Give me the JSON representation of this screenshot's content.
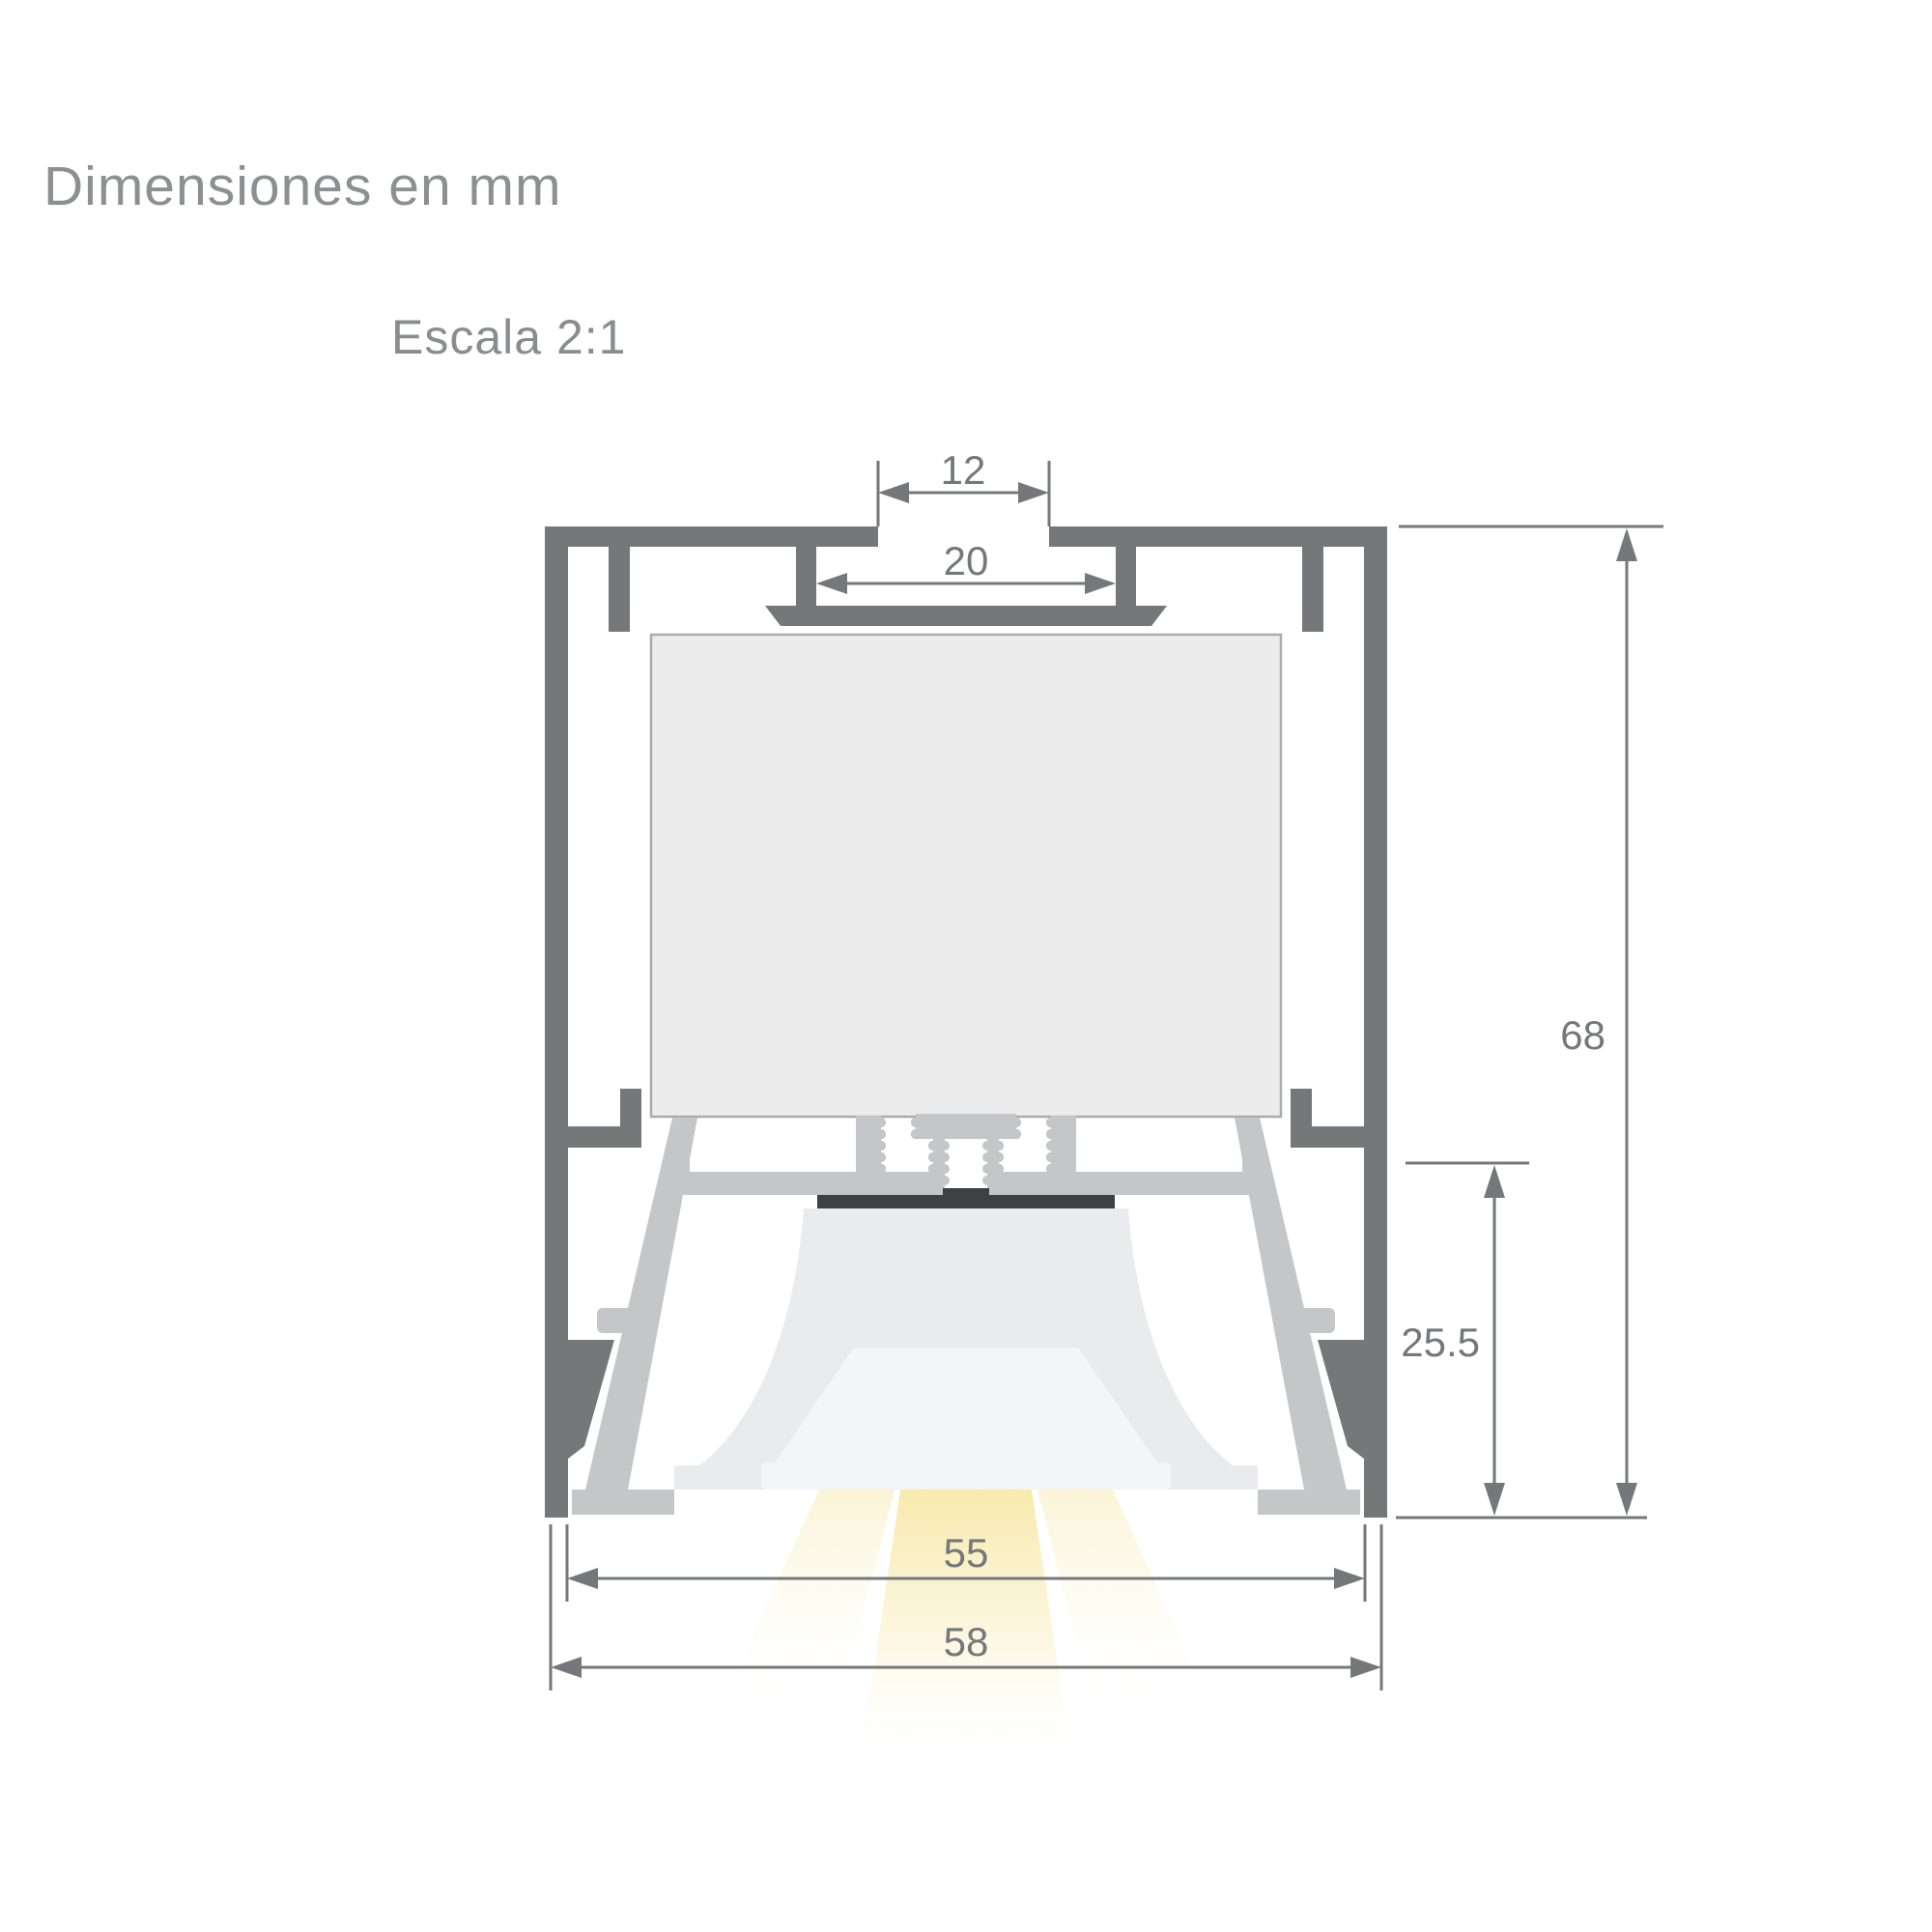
{
  "header": {
    "title": "Dimensiones en mm",
    "scale_label": "Escala 2:1",
    "units": "mm"
  },
  "drawing": {
    "description": "Cross-section technical drawing of a suspended linear LED aluminium profile with internal driver box, screw bosses, LED board, reflector lens and light beam",
    "scale": "2:1",
    "parts": [
      "outer-aluminium-shell",
      "mounting-slot",
      "driver-compartment",
      "screw-bosses",
      "led-board",
      "reflector-lens",
      "diffuser-lip",
      "light-beam"
    ],
    "colors": {
      "profile_gray": "#757779",
      "inner_housing_silver": "#c4c6c8",
      "driver_box_fill": "#ececed",
      "driver_box_border": "#a9abad",
      "lens_gray": "#eaebec",
      "diffuser_white": "#f4f5f6",
      "led_board_dark": "#3e4042",
      "beam_center": "#f7e9a6",
      "beam_side": "#fbf5dd",
      "dimension_gray": "#75777a",
      "title_gray": "#8d8f91"
    }
  },
  "dimensions": {
    "top_slot_width": "12",
    "channel_width": "20",
    "total_height": "68",
    "lower_section_height": "25.5",
    "inner_width": "55",
    "total_width": "58"
  }
}
